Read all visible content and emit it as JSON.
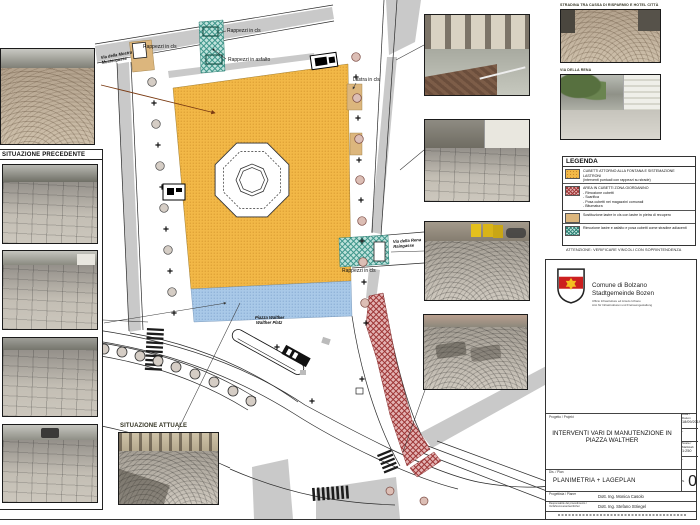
{
  "plan": {
    "labels": {
      "rappezzi_cls_topleft": "Rappezzi in cls",
      "rappezzi_cls_top": "Rappezzi in cls",
      "rappezzi_asfalto": "Rappezzi in asfalto",
      "lastra_cls": "Lastra in cls",
      "rappezzi_cls_right": "Rappezzi in cls",
      "via_mostra_it": "Via della Mostra",
      "via_mostra_de": "Mustergasse",
      "via_rena_it": "Via della Rena",
      "via_rena_de": "Raingasse",
      "piazza_it": "Piazza Walther",
      "piazza_de": "Walther Platz"
    }
  },
  "panels": {
    "precedente": "SITUAZIONE PRECEDENTE",
    "attuale": "SITUAZIONE ATTUALE"
  },
  "top_right": {
    "caption1": "STRADINA TRA CASSA DI RISPARMIO E HOTEL CITTÀ",
    "caption2": "VIA DELLA RENA"
  },
  "legend": {
    "title": "LEGENDA",
    "items": [
      {
        "swatch": "orange-dots",
        "title": "CUBETTI ATTORNO ALLA FONTANA E SISTEMAZIONE LASTRONI",
        "sub": "(interventi puntuali con rappezzi su strade)"
      },
      {
        "swatch": "red-crosshatch",
        "title": "AREA IN CUBETTI ZONA GIORDANINO",
        "bullets": [
          "- Rimozione cubetti",
          "- Scarifica",
          "- Posa cubetti nei magazzini comunali",
          "- Bitumatura"
        ]
      },
      {
        "swatch": "tan-solid",
        "title": "Sostituzione lastre in cls con lastre in pietra di recupero"
      },
      {
        "swatch": "teal-hatch",
        "title": "Rimozione lastre e asfalto e posa cubetti come stradine adiacenti"
      }
    ],
    "note": "ATTENZIONE: VERIFICARE VINCOLI CON SOPRINTENDENZA"
  },
  "title_block": {
    "municipality_it": "Comune di Bolzano",
    "municipality_de": "Stadtgemeinde Bozen",
    "office_it": "Ufficio Infrastrutture ed Arredo Urbano",
    "office_de": "Amt für Infrastrukturen und Freiraumgestaltung",
    "project_label": "Progetto / Projekt",
    "project_title": "INTERVENTI VARI DI MANUTENZIONE IN PIAZZA WALTHER",
    "date_label": "Data / Datum",
    "date_value": "18/09/2019",
    "dash1": "-",
    "scale_label": "Scala / Maßstab",
    "scale_value": "1:250",
    "dash2": "-",
    "drawing_label": "Dis. / Plan",
    "drawing_title": "PLANIMETRIA + LAGEPLAN",
    "number_label": "N.",
    "number_value": "0",
    "designer_label": "Progettista / Planer",
    "designer_value": "Dott. Ing. Monica Casolo",
    "manager_label": "Responsabile del procedimento / Verfahrensverantwortlicher",
    "manager_value": "Dott. Ing. Stefano Striegel"
  },
  "colors": {
    "plaza_orange": "#f2b847",
    "strip_blue": "#a9c9e8",
    "teal_hatch": "#7fc4ba",
    "red_zone": "#c06060",
    "tan_slabs": "#dcb67d"
  }
}
